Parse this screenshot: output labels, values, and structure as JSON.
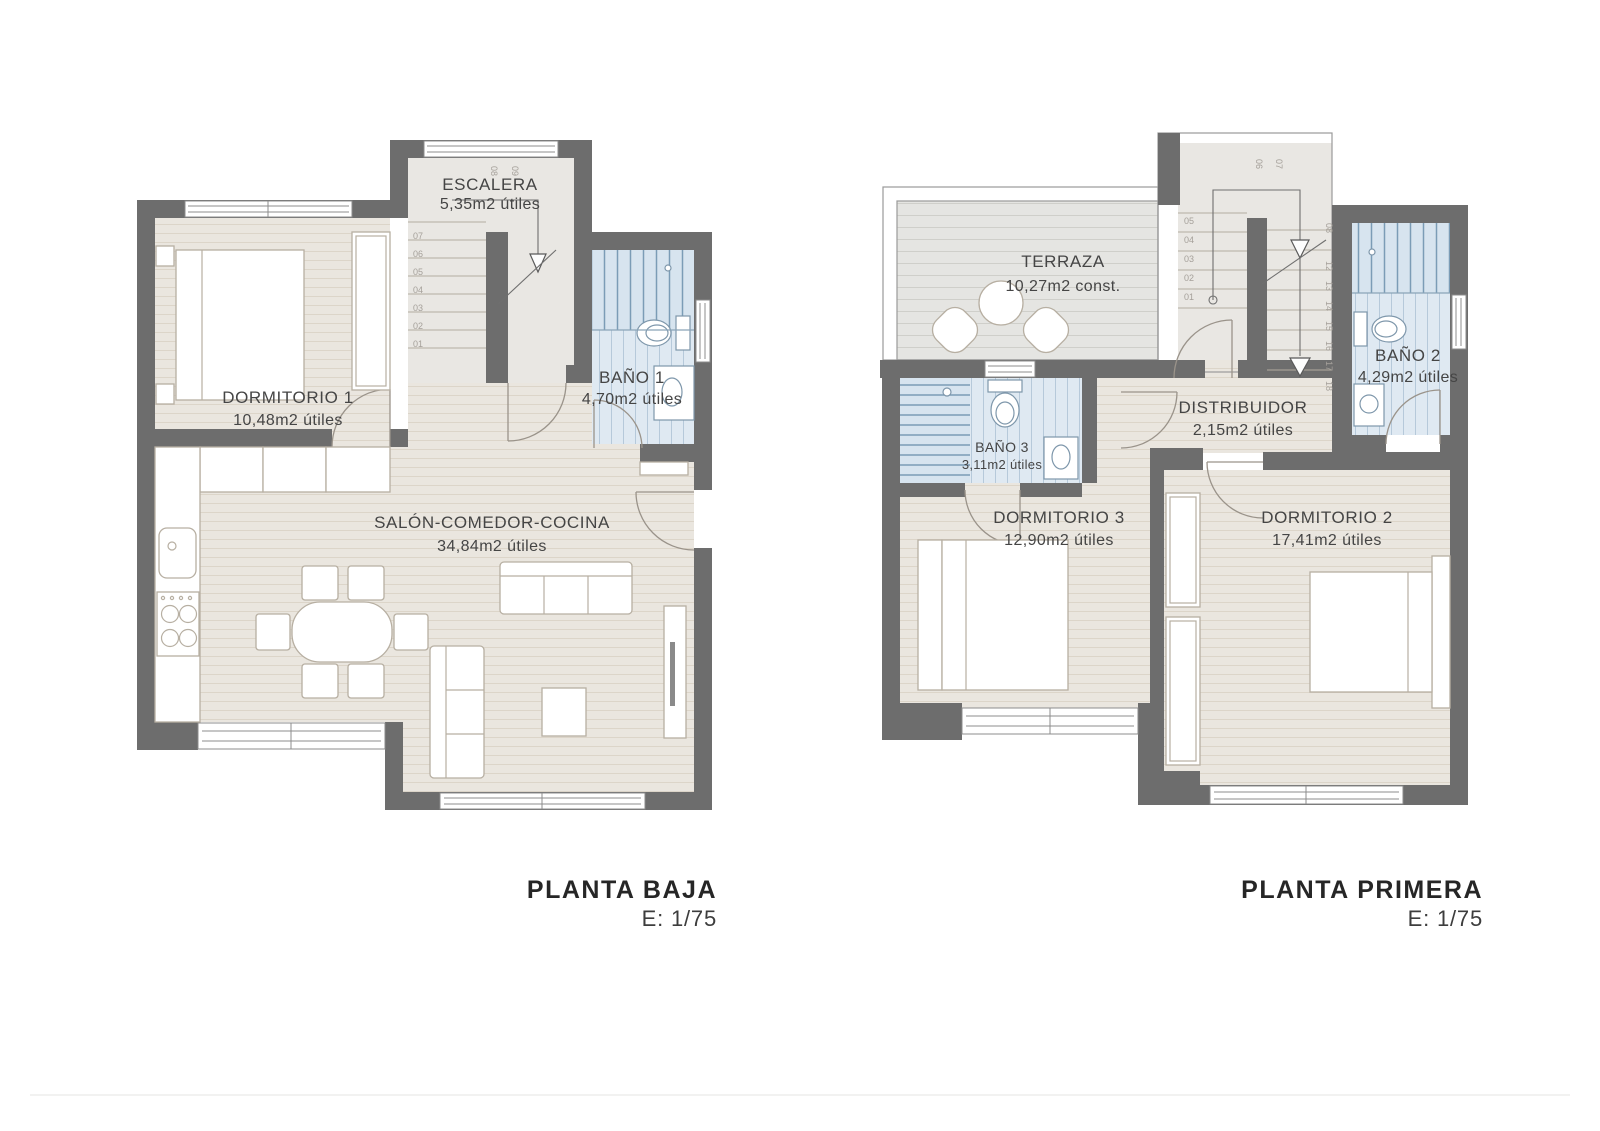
{
  "colors": {
    "wall": "#6d6d6d",
    "wood_floor": "#eae6df",
    "bath_floor": "#dfe9f2",
    "terrace_floor": "#e5e5e2",
    "label_text": "#454545",
    "title_text": "#262626"
  },
  "plans": [
    {
      "title": "PLANTA BAJA",
      "scale": "E: 1/75",
      "rooms": [
        {
          "name": "ESCALERA",
          "area": "5,35m2 útiles"
        },
        {
          "name": "DORMITORIO 1",
          "area": "10,48m2 útiles"
        },
        {
          "name": "BAÑO 1",
          "area": "4,70m2 útiles"
        },
        {
          "name": "SALÓN-COMEDOR-COCINA",
          "area": "34,84m2 útiles"
        }
      ],
      "stair_numbers": [
        "01",
        "02",
        "03",
        "04",
        "05",
        "06",
        "07"
      ],
      "stair_landing_numbers": [
        "08",
        "09"
      ]
    },
    {
      "title": "PLANTA PRIMERA",
      "scale": "E: 1/75",
      "rooms": [
        {
          "name": "TERRAZA",
          "area": "10,27m2 const."
        },
        {
          "name": "BAÑO 3",
          "area": "3,11m2 útiles"
        },
        {
          "name": "DISTRIBUIDOR",
          "area": "2,15m2 útiles"
        },
        {
          "name": "BAÑO 2",
          "area": "4,29m2 útiles"
        },
        {
          "name": "DORMITORIO 3",
          "area": "12,90m2 útiles"
        },
        {
          "name": "DORMITORIO 2",
          "area": "17,41m2 útiles"
        }
      ],
      "stair_numbers": [
        "01",
        "02",
        "03",
        "04",
        "05"
      ],
      "stair_landing_numbers": [
        "06",
        "07"
      ],
      "stair_upper_numbers": [
        "08",
        "12",
        "13",
        "14",
        "15",
        "16",
        "17",
        "18"
      ]
    }
  ]
}
